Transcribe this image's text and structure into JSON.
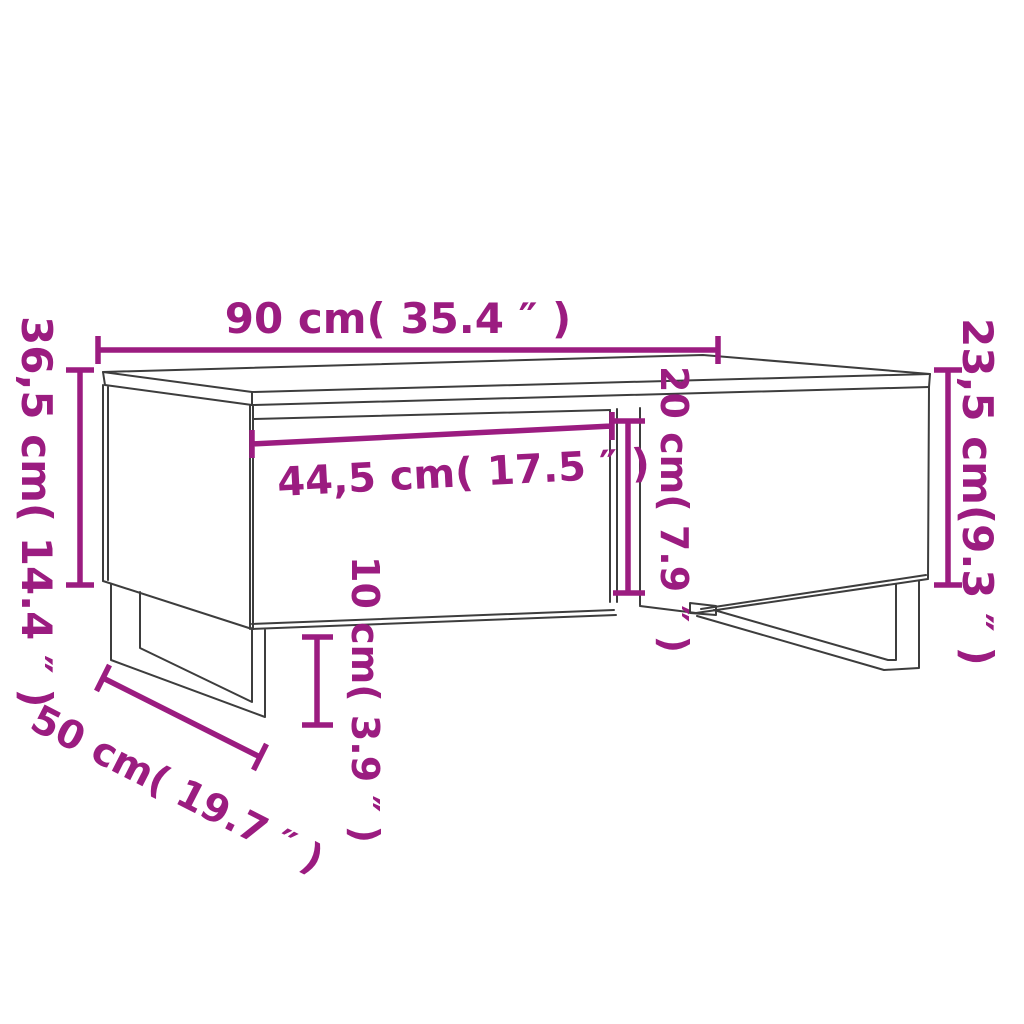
{
  "page": {
    "background": "#ffffff",
    "kind": "product dimension diagram",
    "product": "coffee table with drawer and metal u-legs"
  },
  "drawing": {
    "line_color": "#3d3d3d",
    "accent_color": "#9b1c80"
  },
  "dimensions": {
    "width_top": {
      "label": "90 cm( 35.4 ″ )",
      "value_cm": "90",
      "value_in": "35.4"
    },
    "height_left": {
      "label": "36,5 cm( 14.4 ″ )",
      "value_cm": "36,5",
      "value_in": "14.4"
    },
    "height_right": {
      "label": "23,5 cm(9.3 ″ )",
      "value_cm": "23,5",
      "value_in": "9.3"
    },
    "drawer_width": {
      "label": "44,5 cm( 17.5 ″ )",
      "value_cm": "44,5",
      "value_in": "17.5"
    },
    "drawer_height": {
      "label": "20 cm( 7.9 ″ )",
      "value_cm": "20",
      "value_in": "7.9"
    },
    "leg_clearance": {
      "label": "10 cm( 3.9 ″ )",
      "value_cm": "10",
      "value_in": "3.9"
    },
    "depth": {
      "label": "50 cm( 19.7 ″ )",
      "value_cm": "50",
      "value_in": "19.7"
    }
  }
}
